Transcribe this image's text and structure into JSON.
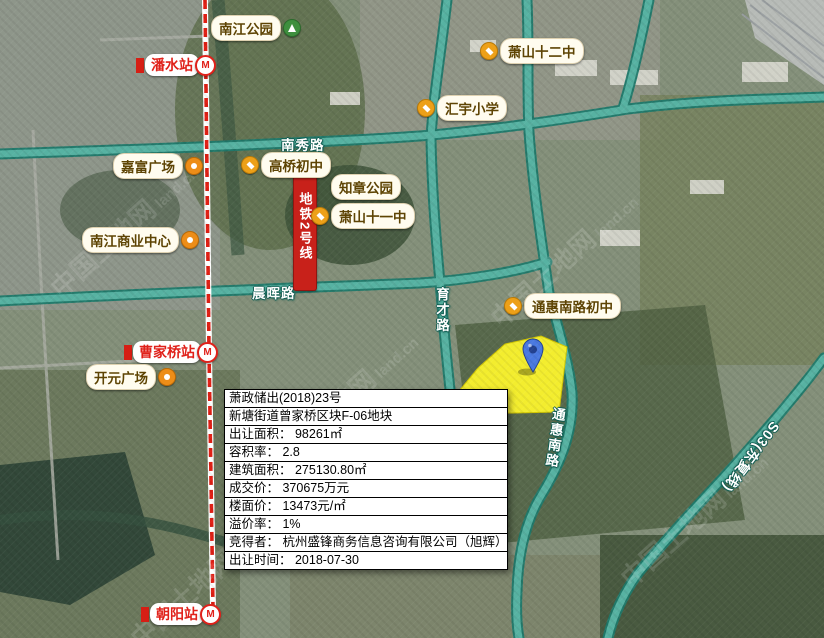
{
  "colors": {
    "road_teal": "#57b2a2",
    "road_casing": "#1f7a6c",
    "metro_red": "#e0211a",
    "parcel_yellow": "#f8f22e",
    "pin_blue": "#4a79e0",
    "poi_text_brown": "#5e4404"
  },
  "icons": {
    "metro_m": "M"
  },
  "watermark": {
    "text": "中国土地网",
    "url": "land.cn"
  },
  "map": {
    "road_labels": {
      "nanxiu": "南秀路",
      "chenhui": "晨晖路",
      "yucai": "育才路",
      "tonghui_south": "通惠南路",
      "s03": "S03(东复线)"
    },
    "metro": {
      "line_label": "地铁2号线",
      "stations": {
        "panshui": "潘水站",
        "caojiaqiao": "曹家桥站",
        "chaoyang": "朝阳站"
      }
    },
    "pois": {
      "nanjiang_park": "南江公园",
      "xiaoshan_12": "萧山十二中",
      "huiyu_primary": "汇宇小学",
      "jiafu_plaza": "嘉富广场",
      "gaoqiao_middle": "高桥初中",
      "zhizhang_park": "知章公园",
      "xiaoshan_11": "萧山十一中",
      "nanjiang_business": "南江商业中心",
      "tonghui_middle": "通惠南路初中",
      "kaiyuan_plaza": "开元广场"
    }
  },
  "infobox": {
    "rows": [
      "萧政储出(2018)23号",
      "新塘街道曾家桥区块F-06地块",
      "出让面积： 98261㎡",
      "容积率： 2.8",
      "建筑面积： 275130.80㎡",
      "成交价： 370675万元",
      "楼面价： 13473元/㎡",
      "溢价率： 1%",
      "竞得者： 杭州盛锋商务信息咨询有限公司（旭辉）",
      "出让时间： 2018-07-30"
    ]
  }
}
